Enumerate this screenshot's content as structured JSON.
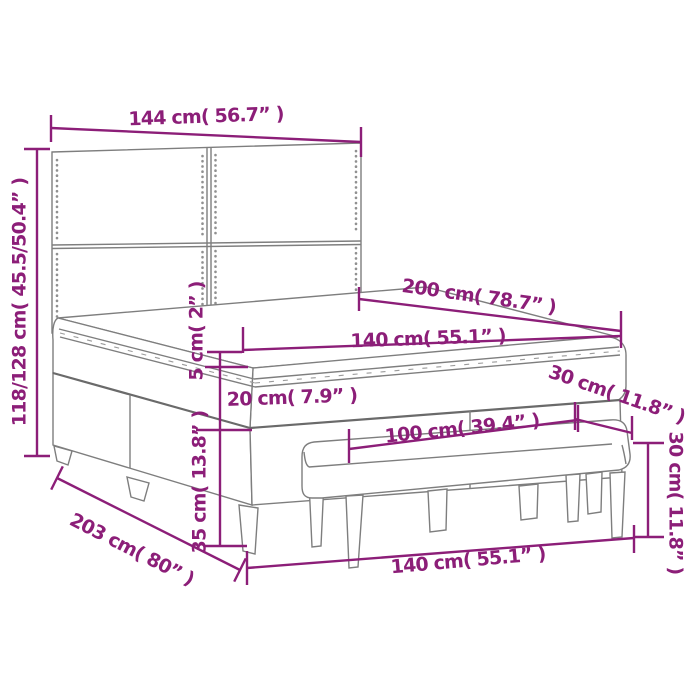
{
  "diagram": {
    "subject": "box-spring-bed-with-headboard-and-bench",
    "colors": {
      "dimension": "#8c1e78",
      "outline": "#7e7e7e",
      "background": "#ffffff"
    },
    "dims": {
      "headboard_width": "144 cm( 56.7” )",
      "headboard_height": "118/128 cm( 45.5/50.4” )",
      "bed_length": "200 cm( 78.7” )",
      "mattress_width": "140 cm( 55.1” )",
      "topper_height": "5 cm( 2” )",
      "mattress_height": "20 cm( 7.9” )",
      "base_height": "35 cm( 13.8” )",
      "total_length": "203 cm( 80” )",
      "bench_width": "100 cm( 39.4” )",
      "bench_depth": "30 cm( 11.8” )",
      "bench_height": "30 cm( 11.8” )",
      "bed_width": "140 cm( 55.1” )"
    }
  }
}
